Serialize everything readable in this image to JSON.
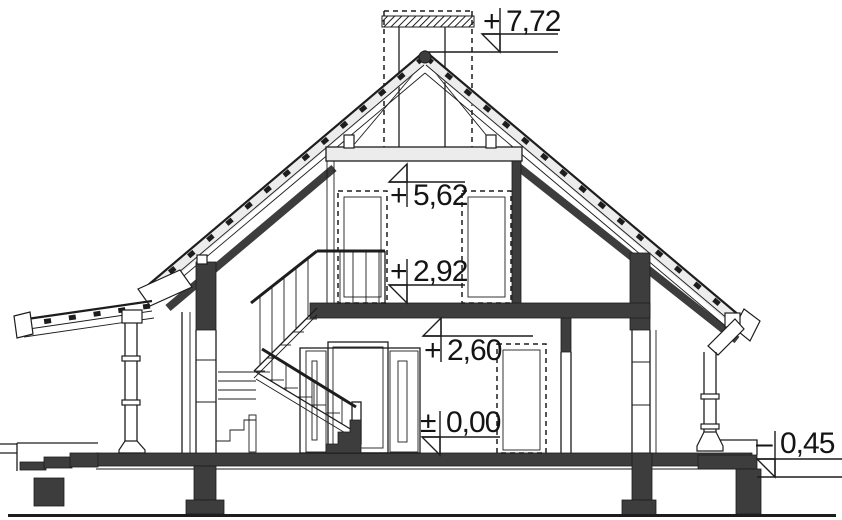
{
  "elevation_markers": [
    {
      "id": "chimney-top",
      "sign": "+",
      "value": "7,72"
    },
    {
      "id": "collar-ceiling",
      "sign": "+",
      "value": "5,62"
    },
    {
      "id": "attic-floor",
      "sign": "+",
      "value": "2,92"
    },
    {
      "id": "ground-ceiling",
      "sign": "+",
      "value": "2,60"
    },
    {
      "id": "ground-floor",
      "sign": "±",
      "value": "0,00"
    },
    {
      "id": "exterior-grade",
      "sign": "–",
      "value": "0,45"
    }
  ],
  "colors": {
    "line": "#1d1d1d",
    "cut_fill": "#3d3d3d",
    "roof_fill": "#ececec",
    "background": "#ffffff"
  }
}
